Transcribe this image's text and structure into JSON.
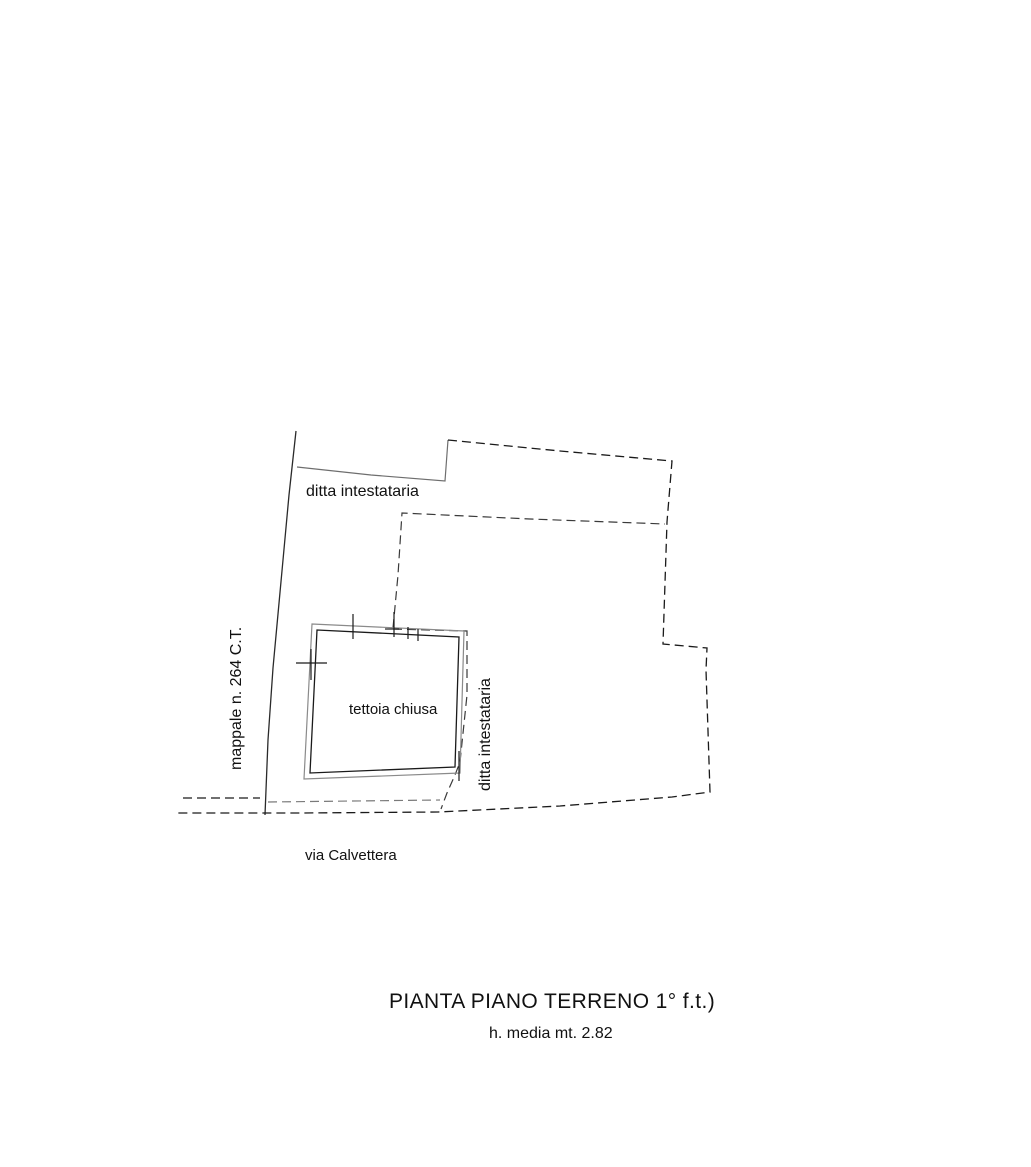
{
  "colors": {
    "background": "#ffffff",
    "line_dark": "#1a1a1a",
    "line_gray": "#7a7a7a",
    "text": "#111111"
  },
  "plan": {
    "labels": {
      "ditta_top": "ditta intestataria",
      "ditta_right": "ditta intestataria",
      "mappale": "mappale n. 264 C.T.",
      "building": "tettoia chiusa",
      "street": "via Calvettera"
    }
  },
  "caption": {
    "title": "PIANTA PIANO TERRENO 1° f.t.)",
    "subtitle": "h. media mt. 2.82"
  }
}
